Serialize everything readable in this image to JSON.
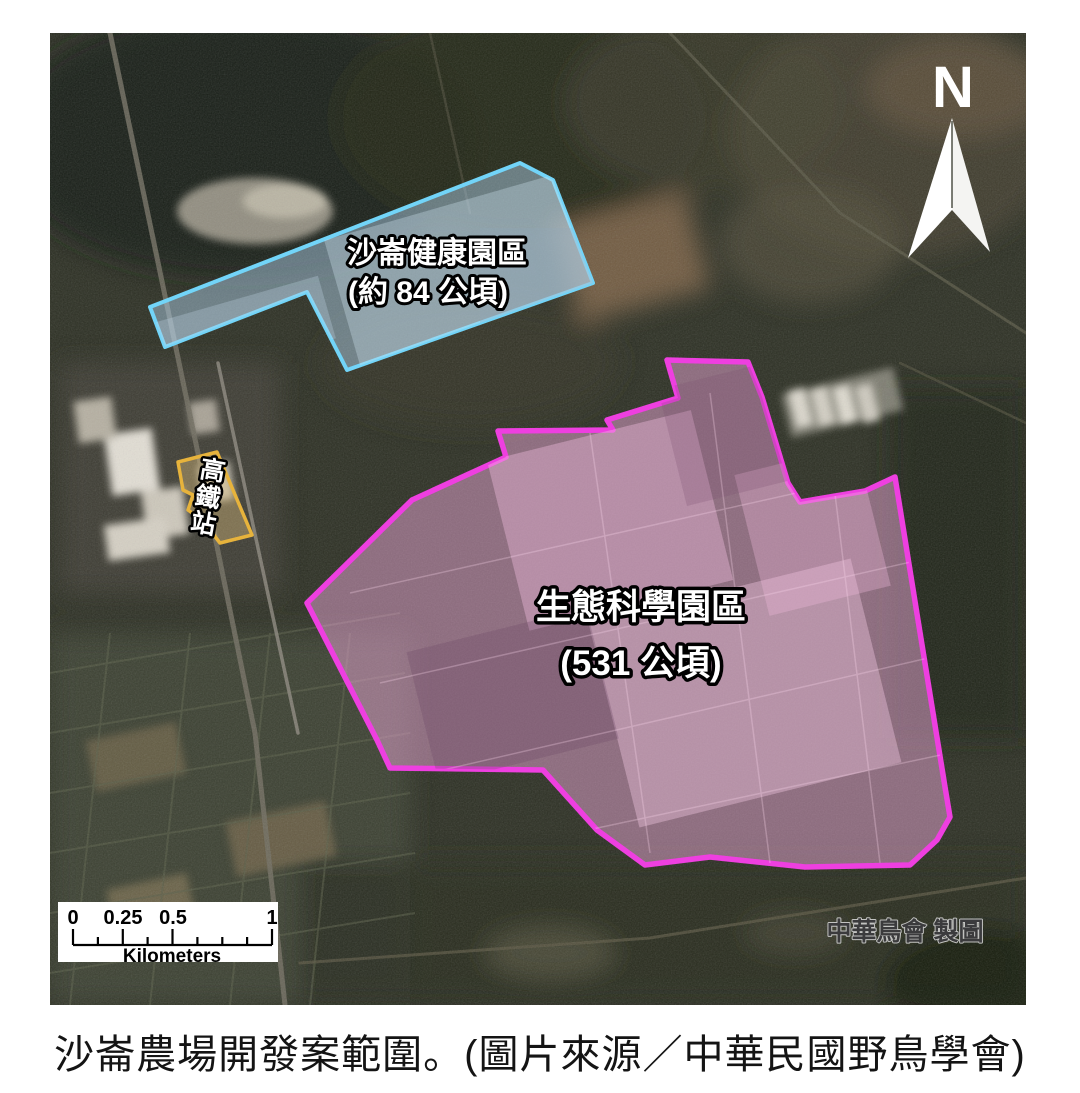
{
  "map": {
    "north_label": "N",
    "zones": {
      "health_park": {
        "line1": "沙崙健康園區",
        "line2": "(約 84 公頃)",
        "stroke": "#72d4f8",
        "fill": "#aac9e2"
      },
      "science_park": {
        "line1": "生態科學園區",
        "line2": "(531 公頃)",
        "stroke": "#ee3fe0",
        "fill": "#e7a6d4"
      },
      "hsr_station": {
        "chars": [
          "高",
          "鐵",
          "站"
        ],
        "stroke": "#e7b33c",
        "fill": "#dcbe7e"
      }
    },
    "scale_bar": {
      "tick_labels": [
        "0",
        "0.25",
        "0.5",
        "1"
      ],
      "unit": "Kilometers"
    },
    "credit": "中華鳥會 製圖"
  },
  "caption": "沙崙農場開發案範圍。(圖片來源／中華民國野鳥學會)"
}
